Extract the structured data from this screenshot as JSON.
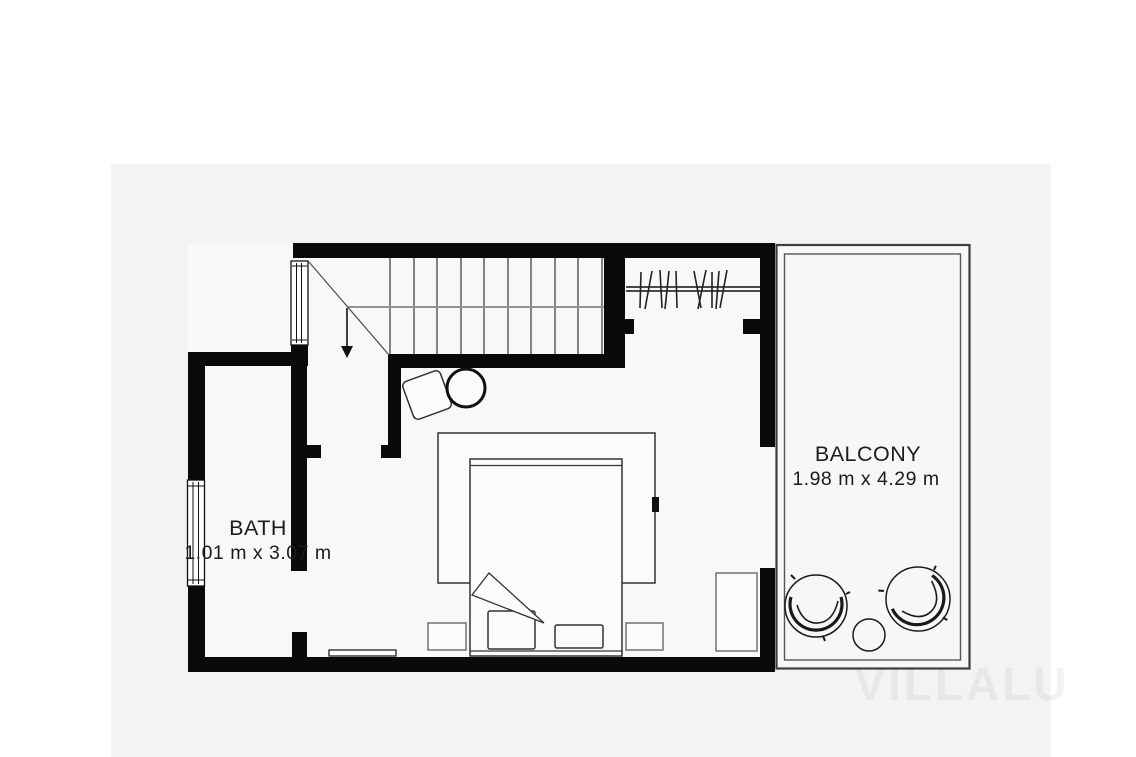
{
  "rooms": {
    "bath": {
      "label": "BATH",
      "dimensions": "1.01 m x 3.07 m"
    },
    "balcony": {
      "label": "BALCONY",
      "dimensions": "1.98 m x 4.29 m"
    }
  },
  "watermark": {
    "text": "VILLALU"
  },
  "colors": {
    "wall": "#0a0a0a",
    "floor": "#f8f8f8",
    "panel": "#f3f3f4",
    "balcony_border": "#3d3d3d",
    "label_text": "#1c1c1c"
  },
  "icons": [
    "staircase-down-icon",
    "stair-direction-arrow-icon",
    "window-icon",
    "wardrobe-rail-icon",
    "double-bed-icon",
    "pillow-icon",
    "nightstand-icon",
    "dresser-icon",
    "side-table-icon",
    "stool-icon",
    "lounge-chair-icon",
    "round-table-icon",
    "threshold-icon"
  ]
}
